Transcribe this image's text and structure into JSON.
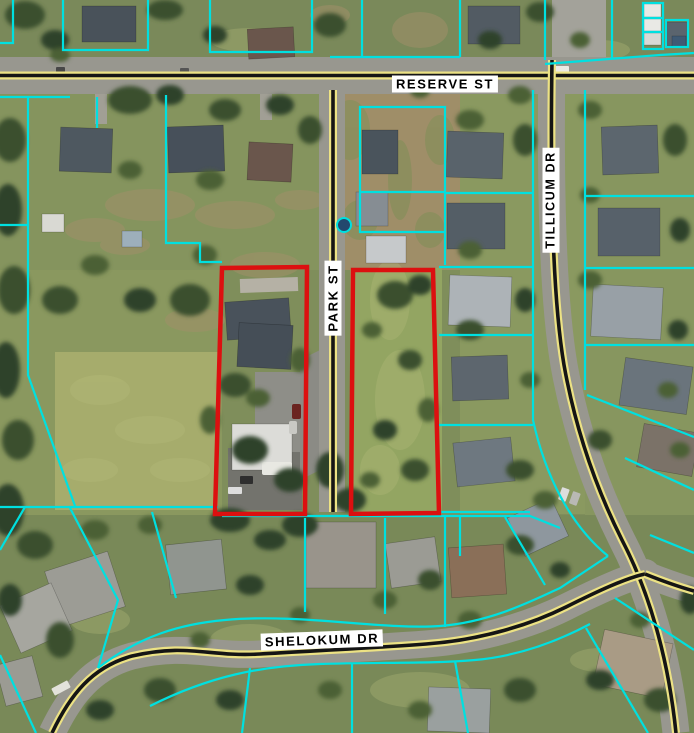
{
  "map": {
    "description": "Aerial photo with GIS parcel overlay; two parcels flanking Park St are outlined in red",
    "streets": [
      {
        "id": "reserve-st",
        "name": "RESERVE ST",
        "orientation": "horizontal"
      },
      {
        "id": "park-st",
        "name": "PARK ST",
        "orientation": "vertical"
      },
      {
        "id": "tillicum-dr",
        "name": "TILLICUM DR",
        "orientation": "vertical"
      },
      {
        "id": "shelokum-dr",
        "name": "SHELOKUM DR",
        "orientation": "horizontal"
      }
    ],
    "highlighted_parcels": {
      "count": 2,
      "outline": "red"
    },
    "colors": {
      "parcel_line": "#00e0e0",
      "highlight_outline": "#dc1010",
      "road_paint_yellow": "#ece284",
      "road_paint_black": "#151515",
      "road_surface": "#98978f",
      "label_background": "#ffffff",
      "label_text": "#000000"
    }
  }
}
